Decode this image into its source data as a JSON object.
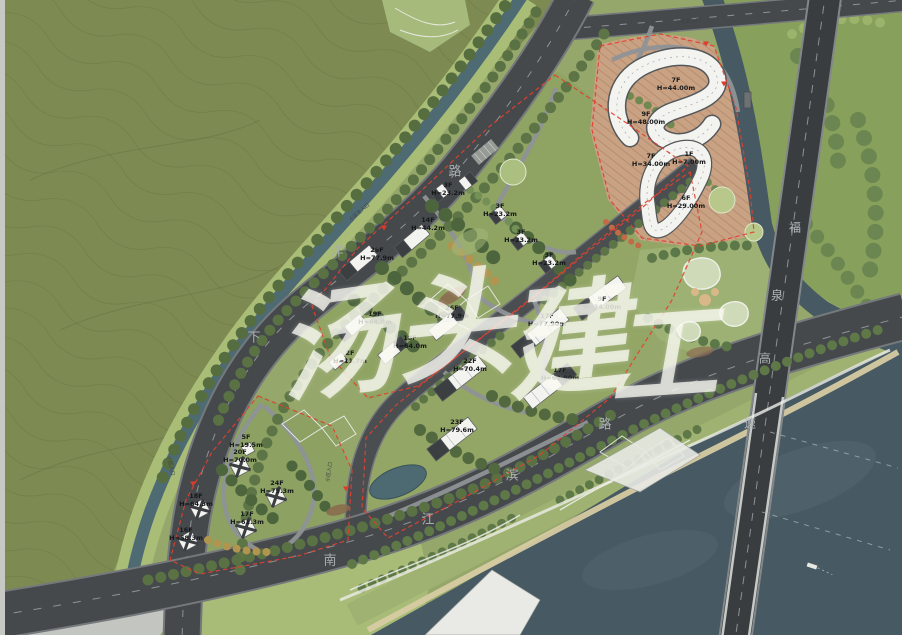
{
  "plan": {
    "type": "residential-masterplan-site-plan",
    "watermark_text": "汤头建工"
  },
  "colors": {
    "field_olive": "#7d8a52",
    "parcel_green": "#8fa363",
    "road_gray": "#45494c",
    "river_blue": "#475962",
    "canal_teal": "#4e6b74",
    "boundary_red": "#e2402f",
    "building_white": "#f3f3f0",
    "terrace_tan": "#c9a183"
  },
  "watermark": {
    "text": "汤头建工",
    "chars": [
      {
        "ch": "汤",
        "x": 334,
        "y": 334,
        "size": 118,
        "rot": -8
      },
      {
        "ch": "头",
        "x": 452,
        "y": 317,
        "size": 118,
        "rot": -6
      },
      {
        "ch": "建",
        "x": 565,
        "y": 331,
        "size": 122,
        "rot": -6
      },
      {
        "ch": "工",
        "x": 662,
        "y": 347,
        "size": 108,
        "rot": -4
      }
    ]
  },
  "roads": [
    {
      "name": "下洋路",
      "font_px": 13,
      "color": "#a9adaf",
      "chars": [
        {
          "ch": "下",
          "x": 254,
          "y": 336
        },
        {
          "ch": "洋",
          "x": 337,
          "y": 250
        },
        {
          "ch": "路",
          "x": 455,
          "y": 170
        }
      ]
    },
    {
      "name": "南江滨路",
      "font_px": 13,
      "color": "#a9adaf",
      "chars": [
        {
          "ch": "南",
          "x": 330,
          "y": 559
        },
        {
          "ch": "江",
          "x": 428,
          "y": 518
        },
        {
          "ch": "滨",
          "x": 512,
          "y": 474
        },
        {
          "ch": "路",
          "x": 605,
          "y": 423
        }
      ]
    },
    {
      "name": "福泉高速",
      "font_px": 12,
      "color": "#b3b7b9",
      "chars": [
        {
          "ch": "福",
          "x": 795,
          "y": 227
        },
        {
          "ch": "泉",
          "x": 777,
          "y": 295
        },
        {
          "ch": "高",
          "x": 765,
          "y": 358
        },
        {
          "ch": "速",
          "x": 750,
          "y": 423
        }
      ]
    }
  ],
  "building_labels": [
    {
      "floors": "26F",
      "height": "H=77.9m",
      "x": 377,
      "y": 255
    },
    {
      "floors": "14F",
      "height": "H=44.2m",
      "x": 428,
      "y": 225
    },
    {
      "floors": "3F",
      "height": "H=23.2m",
      "x": 448,
      "y": 190
    },
    {
      "floors": "3F",
      "height": "H=23.2m",
      "x": 500,
      "y": 211
    },
    {
      "floors": "3F",
      "height": "H=23.2m",
      "x": 521,
      "y": 237
    },
    {
      "floors": "3F",
      "height": "H=23.2m",
      "x": 549,
      "y": 260
    },
    {
      "floors": "19F",
      "height": "H=64.0m",
      "x": 375,
      "y": 319
    },
    {
      "floors": "18F",
      "height": "H=64.0m",
      "x": 410,
      "y": 343
    },
    {
      "floors": "2F",
      "height": "H=11.7m",
      "x": 350,
      "y": 358
    },
    {
      "floors": "9F",
      "height": "H=34.00m",
      "x": 602,
      "y": 304
    },
    {
      "floors": "17F",
      "height": "H=77.90m",
      "x": 547,
      "y": 321
    },
    {
      "floors": "26F",
      "height": "H=77.9m",
      "x": 452,
      "y": 313
    },
    {
      "floors": "22F",
      "height": "H=70.4m",
      "x": 470,
      "y": 366
    },
    {
      "floors": "17F",
      "height": "H=62.90m",
      "x": 560,
      "y": 375
    },
    {
      "floors": "23F",
      "height": "H=79.6m",
      "x": 457,
      "y": 427
    },
    {
      "floors": "7F",
      "height": "H=44.00m",
      "x": 676,
      "y": 85
    },
    {
      "floors": "9F",
      "height": "H=48.00m",
      "x": 646,
      "y": 119
    },
    {
      "floors": "7F",
      "height": "H=34.00m",
      "x": 651,
      "y": 161
    },
    {
      "floors": "1F",
      "height": "H=7.00m",
      "x": 689,
      "y": 159
    },
    {
      "floors": "6F",
      "height": "H=29.00m",
      "x": 686,
      "y": 203
    },
    {
      "floors": "5F",
      "height": "H=19.5m",
      "x": 246,
      "y": 442
    },
    {
      "floors": "20F",
      "height": "H=70.0m",
      "x": 240,
      "y": 457
    },
    {
      "floors": "24F",
      "height": "H=75.3m",
      "x": 277,
      "y": 488
    },
    {
      "floors": "18F",
      "height": "H=64.3m",
      "x": 196,
      "y": 501
    },
    {
      "floors": "17F",
      "height": "H=61.3m",
      "x": 247,
      "y": 519
    },
    {
      "floors": "16F",
      "height": "H=58.3m",
      "x": 186,
      "y": 535
    }
  ],
  "entrances": [
    {
      "label": "小区主入口",
      "x": 360,
      "y": 213,
      "rot": -40
    },
    {
      "label": "小区主入口",
      "x": 688,
      "y": 22,
      "rot": -5
    },
    {
      "label": "小区入口",
      "x": 170,
      "y": 466,
      "rot": 78
    },
    {
      "label": "小区入口",
      "x": 330,
      "y": 472,
      "rot": -82
    }
  ],
  "entrance_markers": [
    {
      "x": 384,
      "y": 228
    },
    {
      "x": 706,
      "y": 44
    },
    {
      "x": 724,
      "y": 84
    },
    {
      "x": 193,
      "y": 484
    },
    {
      "x": 346,
      "y": 489
    }
  ]
}
